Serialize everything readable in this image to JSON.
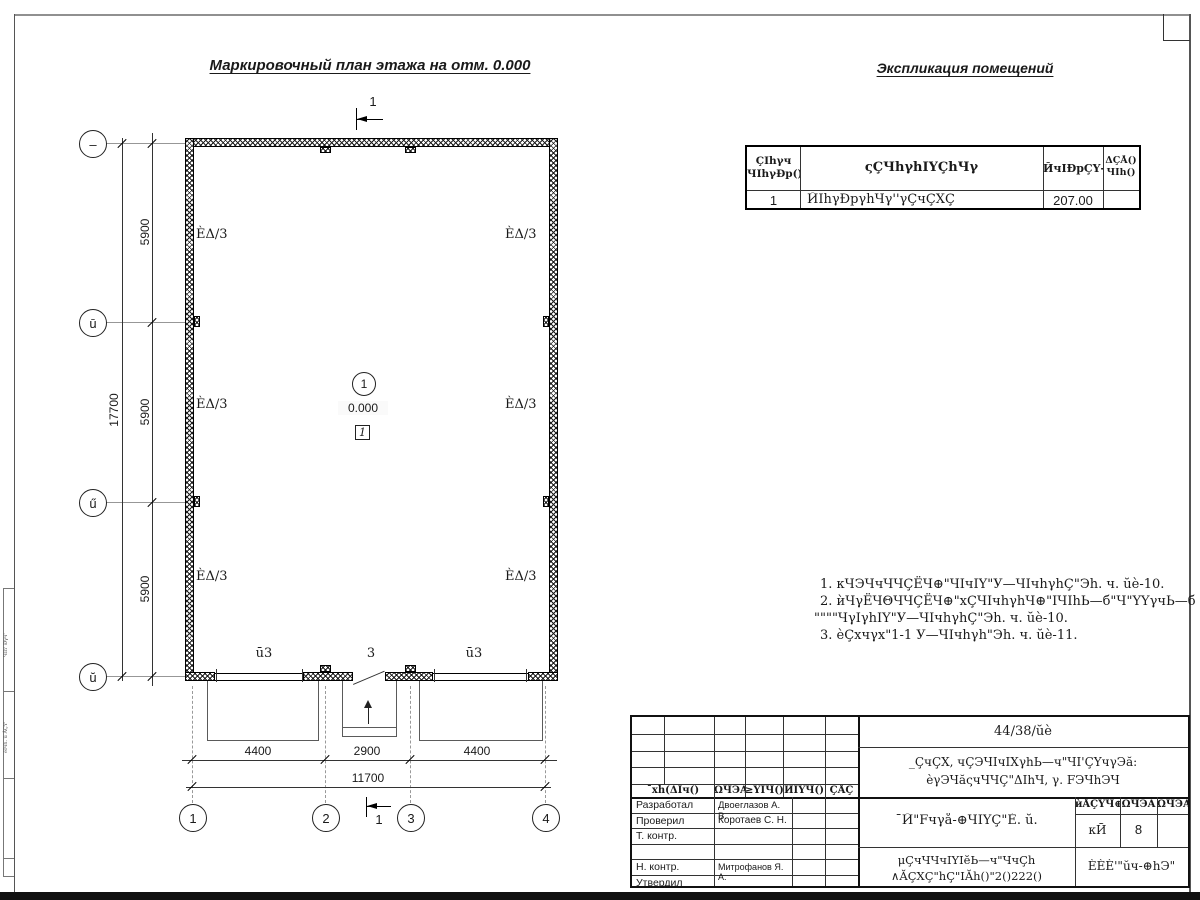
{
  "titles": {
    "plan": "Маркировочный план этажа на отм. 0.000",
    "explication": "Экспликация помещений"
  },
  "explication_table": {
    "headers": {
      "num": "ÇΙhγч\nЧΙhγÐр()",
      "name": "ςÇЧhγhΙΥÇhЧγ",
      "area": "ЙчΙÐрÇΥ-",
      "note": "ΔÇÅ()\nЧΙh()"
    },
    "row": {
      "num": "1",
      "name": "ЙΙhγÐрγhЧγ''γÇчÇΧÇ",
      "area": "207.00",
      "note": ""
    }
  },
  "notes": {
    "line1": "1. кЧЭЧчЧЧÇЁЧ⊕\"ЧΙчΙΥ\"У—ЧΙчhγhÇ\"Эh. ч. ŭè-10.",
    "line2": "2. ѝЧγЁЧΘЧЧÇЁЧ⊕\"хÇЧΙчhγhЧ⊕\"ΙЧΙhЬ—б\"Ч\"ΥΥγчЬ—б",
    "line3": "\"\"\"\"ЧγΙγhΙΥ\"У—ЧΙчhγhÇ\"Эh. ч. ŭè-10.",
    "line4": "3. ѐÇхчγх\"1-1 У—ЧΙчhγh\"Эh. ч. ŭè-11."
  },
  "plan": {
    "section_mark": "1",
    "room_label": "ÈΔ/3",
    "room_number": "1",
    "elevation": "0.000",
    "floor_type": "1",
    "gate_left": "ū3",
    "door_center": "3",
    "gate_right": "ū3",
    "grid_cols": [
      "1",
      "2",
      "3",
      "4"
    ],
    "grid_rows": [
      "–",
      "ū",
      "ű",
      "ŭ"
    ],
    "dim_v1": "5900",
    "dim_v2": "5900",
    "dim_v3": "5900",
    "dim_v_total": "17700",
    "dim_h1": "4400",
    "dim_h2": "2900",
    "dim_h3": "4400",
    "dim_h_total": "11700"
  },
  "title_block": {
    "doc_number": "44/38/ŭè",
    "project_line1": "_ÇчÇΧ, чÇЭЧΙчΙΧγhЬ—ч\"ЧΙ'ÇΥчγЭă:",
    "project_line2": "ѐγЭЧăςчЧЧÇ\"ΔΙhЧ, γ. FЭЧhЭЧ",
    "sheet_title": "¯Й\"Fчγå-⊕ЧΙΥÇ\"È. ŭ.",
    "org_line1": "μÇчЧЧчΙΥΙĕЬ—ч\"ЧчÇh",
    "org_line2": "∧ĂÇΧÇ\"hÇ\"ΙĂh()\"2()222()",
    "company": "ÈÈÈ'\"ŭч-⊕hЭ\"",
    "rev_headers": [
      "¯хh(ΔΙч()",
      "ΩЧЭĂ",
      "≥ΥΙЧ()",
      "ЙΙΥЧ()",
      "ÇÅÇ"
    ],
    "stage_headers": [
      "ѝÅÇΥЧ⊕",
      "ΩЧЭĂ",
      "ΩЧЭĂΙΥ"
    ],
    "stage_value": "кЙ",
    "sheet_value": "8",
    "sheets_value": "",
    "roles": [
      {
        "role": "Разработал",
        "name": "Двоеглазов А. В."
      },
      {
        "role": "Проверил",
        "name": "Коротаев С. Н."
      },
      {
        "role": "Т. контр.",
        "name": ""
      },
      {
        "role": "",
        "name": ""
      },
      {
        "role": "Н. контр.",
        "name": "Митрофанов Я. А."
      },
      {
        "role": "Утвердил",
        "name": ""
      }
    ]
  },
  "margin": {
    "label1": "ЧΙh' Ðγч'",
    "label2": "ѐΙчh. ŭ ÅÇΥ'"
  }
}
